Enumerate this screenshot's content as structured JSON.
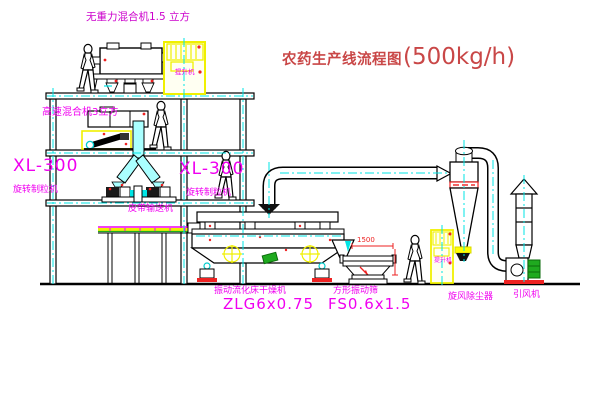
{
  "title": {
    "text": "农药生产线流程图",
    "capacity": "(500kg/h)"
  },
  "equipment_labels": {
    "gravity_mixer": "无重力混合机1.5 立方",
    "high_speed_mixer": "高速混合机3立方",
    "granulator_left": {
      "model": "XL-300",
      "name": "旋转制粒机"
    },
    "granulator_right": {
      "model": "XL-300",
      "name": "旋转制粒机"
    },
    "belt_conveyor": "皮带输送机",
    "fluid_bed_dryer": {
      "name": "振动流化床干燥机",
      "model": "ZLG6x0.75"
    },
    "vibrating_screen": {
      "name": "方形振动筛",
      "model": "FS0.6x1.5",
      "dimension": "1500"
    },
    "cyclone": "旋风除尘器",
    "induced_draft_fan": "引风机",
    "elevator_top": "提升机",
    "elevator_right": "提升机"
  },
  "colors": {
    "label_magenta": "#f000f0",
    "label_violet": "#cc00cc",
    "title_red": "#c94747",
    "accent_red": "#ee2222",
    "accent_yellow": "#f0f000",
    "accent_cyan": "#00e5e5",
    "accent_green": "#1faa1f",
    "line_black": "#000000"
  }
}
